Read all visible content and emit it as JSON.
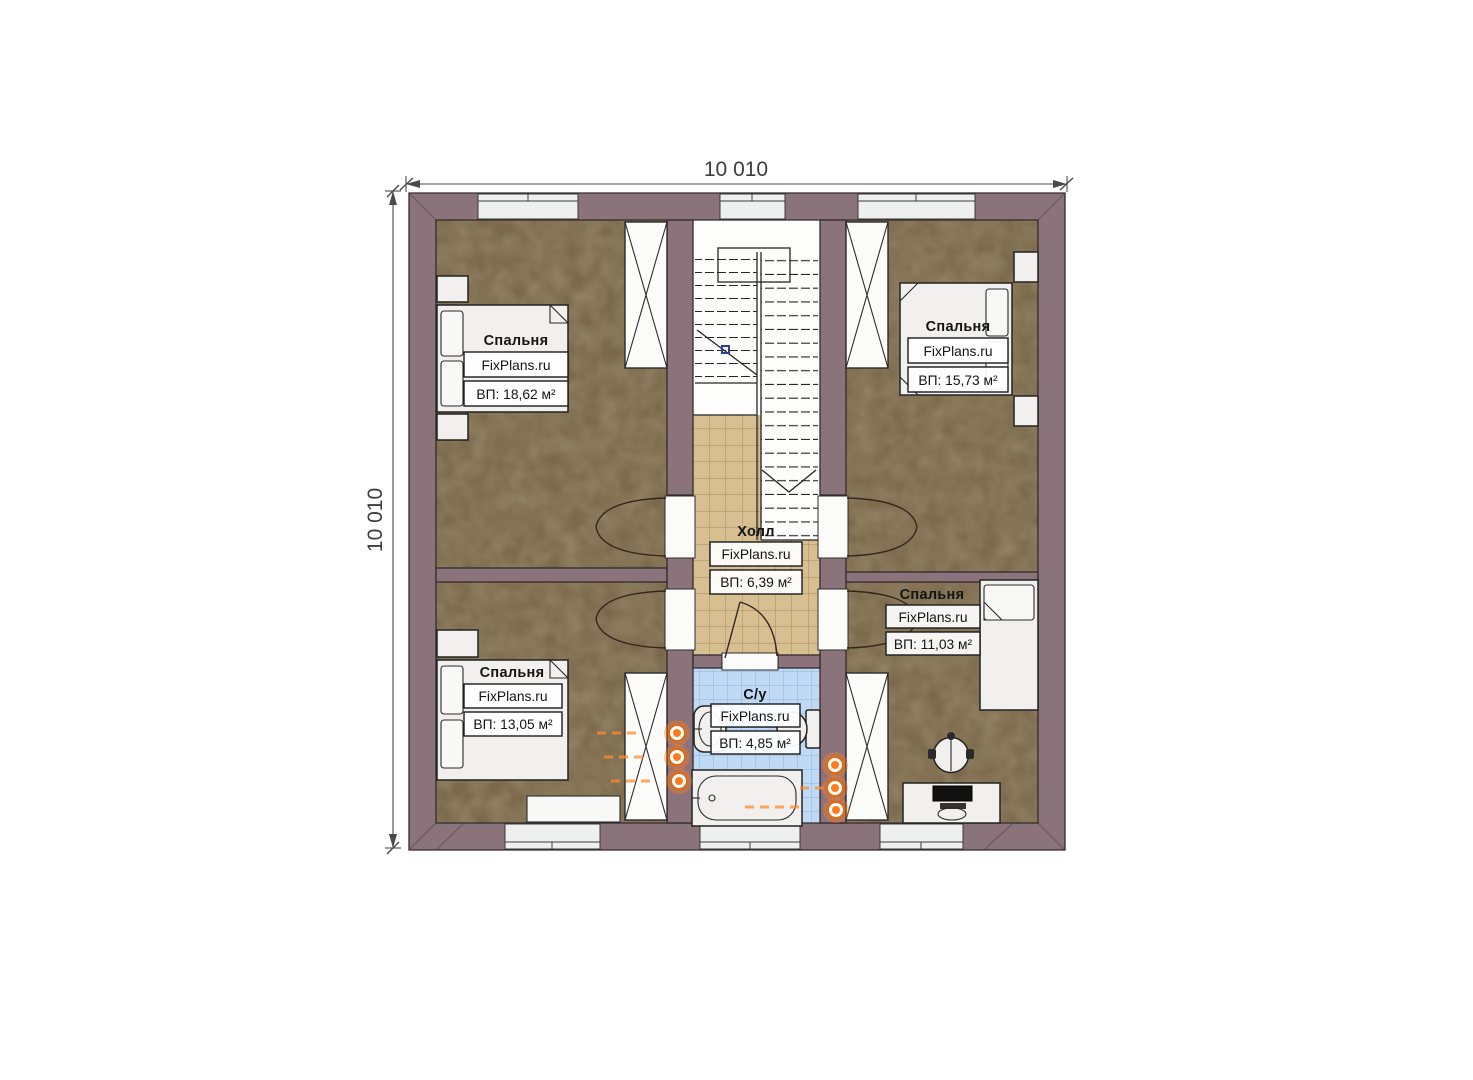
{
  "meta": {
    "type": "floor-plan",
    "floor": "attic",
    "brand": "FixPlans.ru"
  },
  "dimensions": {
    "top": "10 010",
    "left": "10 010"
  },
  "rooms": [
    {
      "id": "bedroom-top-left",
      "name": "Спальня",
      "brand": "FixPlans.ru",
      "area": "ВП: 18,62 м²"
    },
    {
      "id": "bedroom-top-right",
      "name": "Спальня",
      "brand": "FixPlans.ru",
      "area": "ВП: 15,73 м²"
    },
    {
      "id": "hall",
      "name": "Холл",
      "brand": "FixPlans.ru",
      "area": "ВП: 6,39 м²"
    },
    {
      "id": "bedroom-right",
      "name": "Спальня",
      "brand": "FixPlans.ru",
      "area": "ВП: 11,03 м²"
    },
    {
      "id": "bedroom-bottom-left",
      "name": "Спальня",
      "brand": "FixPlans.ru",
      "area": "ВП: 13,05 м²"
    },
    {
      "id": "bathroom",
      "name": "С/у",
      "brand": "FixPlans.ru",
      "area": "ВП: 4,85 м²"
    }
  ],
  "colors": {
    "wall": "#8b737b",
    "bedroom_floor": "#7c694b",
    "hall_floor": "#d8bf92",
    "bath_floor": "#c0d9f4",
    "radiator": "#ff7b1c",
    "furniture": "#f1f0ee"
  }
}
